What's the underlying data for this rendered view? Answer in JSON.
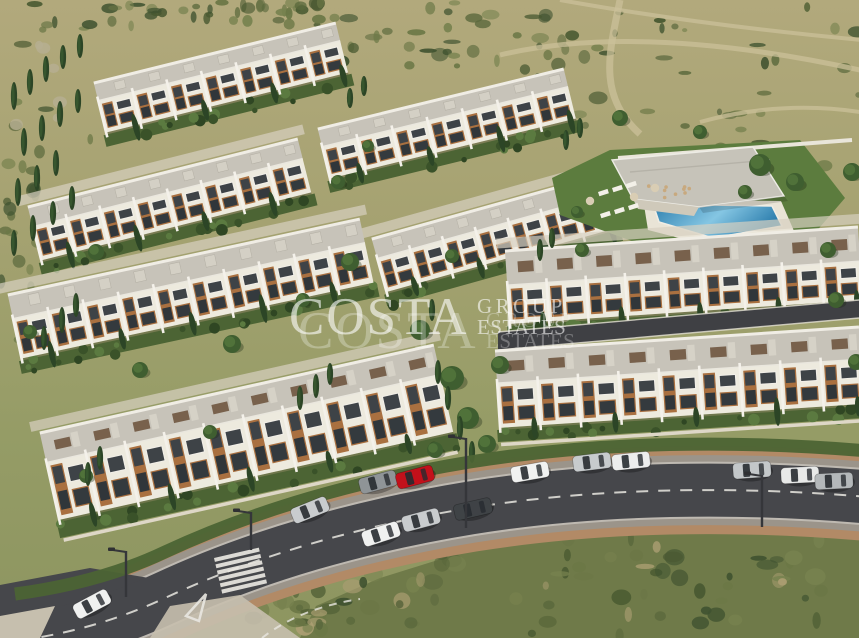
{
  "watermark": {
    "brand": "COSTA",
    "group": "GROUP",
    "estates": "ESTATES",
    "color": "#ffffff"
  },
  "scene": {
    "subject": "aerial render of hillside townhouse development",
    "counts": {
      "building_rows": 8,
      "cars": 13,
      "swimming_pools": 1,
      "street_lamps": 4,
      "pedestrian_crossings": 1
    }
  },
  "palette": {
    "hill_top": "#b2a97c",
    "hill_mid": "#a5a271",
    "field": "#959c66",
    "field_low": "#8d9560",
    "scrub": "#6f7a49",
    "lawn": "#5c7c3e",
    "hedge": "#4c6434",
    "roof": "#c7c3b9",
    "facade": "#edeade",
    "wood": "#a97040",
    "glass": "#3e4347",
    "asphalt": "#46474b",
    "brick_path": "#b28a66",
    "sidewalk": "#c6bfae",
    "parking": "#9b948a",
    "marking": "#e9e7e1",
    "pool_deep": "#2e7fae",
    "pool_light": "#85c6e3",
    "clubhouse_roof": "#c6c3b9",
    "car_red": "#c3111b"
  }
}
